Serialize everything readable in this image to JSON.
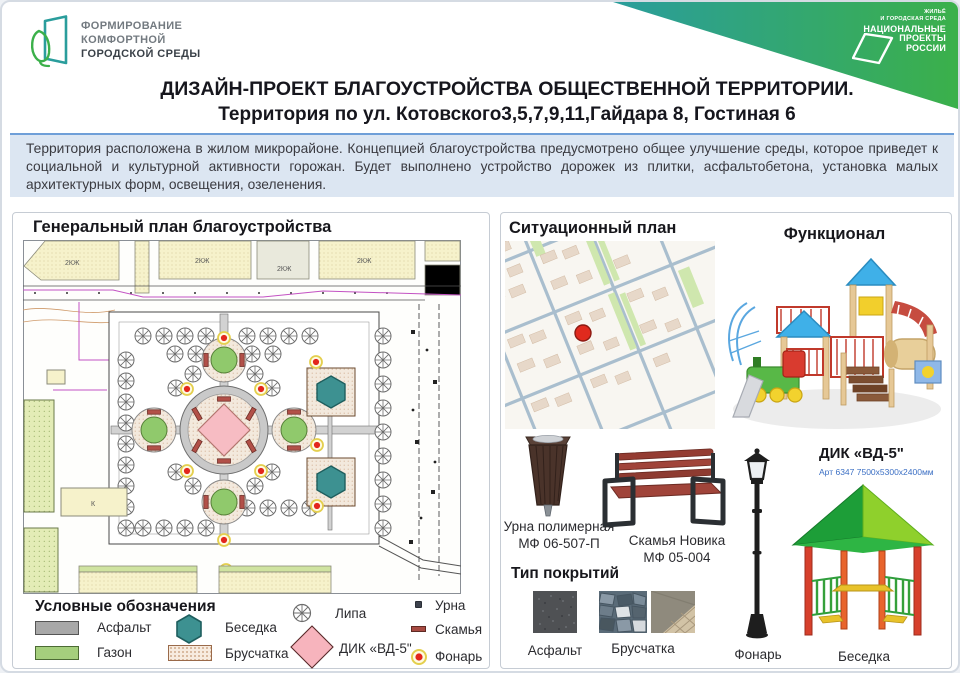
{
  "header": {
    "logo": {
      "line1": "ФОРМИРОВАНИЕ",
      "line2": "КОМФОРТНОЙ",
      "line3": "ГОРОДСКОЙ СРЕДЫ"
    },
    "national_badge": {
      "program_line1": "ЖИЛЬЁ",
      "program_line2": "И ГОРОДСКАЯ СРЕДА",
      "brand_line1": "НАЦИОНАЛЬНЫЕ",
      "brand_line2": "ПРОЕКТЫ",
      "brand_line3": "РОССИИ"
    },
    "title_line1": "ДИЗАЙН-ПРОЕКТ БЛАГОУСТРОЙСТВА ОБЩЕСТВЕННОЙ ТЕРРИТОРИИ.",
    "title_line2": "Территория по ул. Котовского3,5,7,9,11,Гайдара 8, Гостиная 6"
  },
  "intro": {
    "text": "Территория расположена в жилом микрорайоне. Концепцией благоустройства предусмотрено общее улучшение среды, которое приведет к социальной и культурной активности горожан. Будет выполнено устройство дорожек из плитки, асфальтобетона, установка малых архитектурных форм, освещения,  озеленения."
  },
  "general_plan": {
    "title": "Генеральный план благоустройства",
    "building_label": "2КЖ",
    "boiler_label": "К",
    "legend": {
      "title": "Условные обозначения",
      "items": [
        {
          "label": "Асфальт",
          "icon": "asphalt-swatch"
        },
        {
          "label": "Газон",
          "icon": "lawn-swatch"
        },
        {
          "label": "Беседка",
          "icon": "gazebo-hexagon"
        },
        {
          "label": "Брусчатка",
          "icon": "paver-swatch"
        },
        {
          "label": "Липа",
          "icon": "linden-tree"
        },
        {
          "label": "ДИК «ВД-5\"",
          "icon": "dik-diamond"
        },
        {
          "label": "Урна",
          "icon": "urn-square"
        },
        {
          "label": "Скамья",
          "icon": "bench-bar"
        },
        {
          "label": "Фонарь",
          "icon": "lantern-dot"
        }
      ]
    }
  },
  "situation_plan": {
    "title": "Ситуационный план"
  },
  "functional": {
    "title": "Функционал",
    "dik": {
      "name": "ДИК «ВД-5\"",
      "art": "Арт 6347 7500х5300х2400мм"
    },
    "urn": {
      "name_line1": "Урна полимерная",
      "name_line2": "МФ 06-507-П"
    },
    "bench": {
      "name_line1": "Скамья Новика",
      "name_line2": "МФ 05-004"
    },
    "lamp": {
      "name": "Фонарь"
    },
    "gazebo": {
      "name": "Беседка"
    }
  },
  "coverings": {
    "title": "Тип покрытий",
    "items": [
      "Асфальт",
      "Брусчатка"
    ]
  },
  "colors": {
    "ribbon_teal": "#2a9d9c",
    "ribbon_green": "#3bb04a",
    "logo_teal": "#2a9d9c",
    "logo_green": "#3bb04a",
    "intro_bg": "#dce6f2",
    "intro_border": "#6f9fd8",
    "asphalt": "#a8a8a8",
    "lawn": "#a5cf7d",
    "gazebo_teal": "#3d9191",
    "paver_bg": "#f3e9dd",
    "dik_pink": "#f7bcc3",
    "lamp_red": "#e3261d",
    "lamp_halo": "#e4cf4e",
    "map_marker_red": "#e02a1e"
  }
}
